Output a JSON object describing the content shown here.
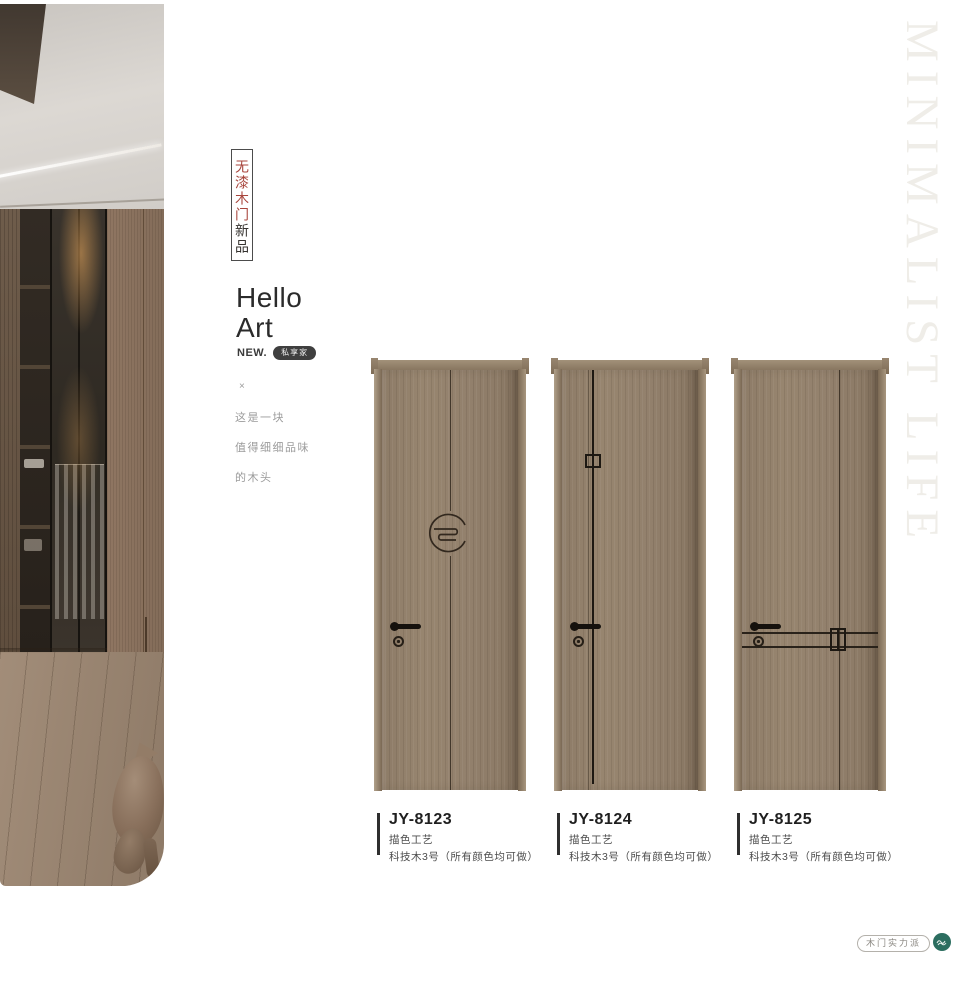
{
  "window": {
    "width": 980,
    "height": 999
  },
  "photo": {
    "description": "interior walk-in wardrobe with glass doors and animal figurine"
  },
  "intro": {
    "vertical_tag_red": "无漆木门",
    "vertical_tag_dark": "新品",
    "title_line1": "Hello",
    "title_line2": "Art",
    "new_label": "NEW.",
    "new_badge": "私享家",
    "asterisk_mark": "×",
    "tagline": [
      "这是一块",
      "值得细细品味",
      "的木头"
    ]
  },
  "products": [
    {
      "model": "JY-8123",
      "craft": "描色工艺",
      "material": "科技木3号（所有颜色均可做）"
    },
    {
      "model": "JY-8124",
      "craft": "描色工艺",
      "material": "科技木3号（所有颜色均可做）"
    },
    {
      "model": "JY-8125",
      "craft": "描色工艺",
      "material": "科技木3号（所有颜色均可做）"
    }
  ],
  "side_text": "MINIMALIST LIFE",
  "footer": {
    "badge": "木门实力派"
  },
  "colors": {
    "accent_red": "#a8453c",
    "badge_dark": "#3f3f3f",
    "brand_teal": "#2c6e60",
    "door_wood": "#92806c",
    "page_bg": "#ffffff"
  }
}
